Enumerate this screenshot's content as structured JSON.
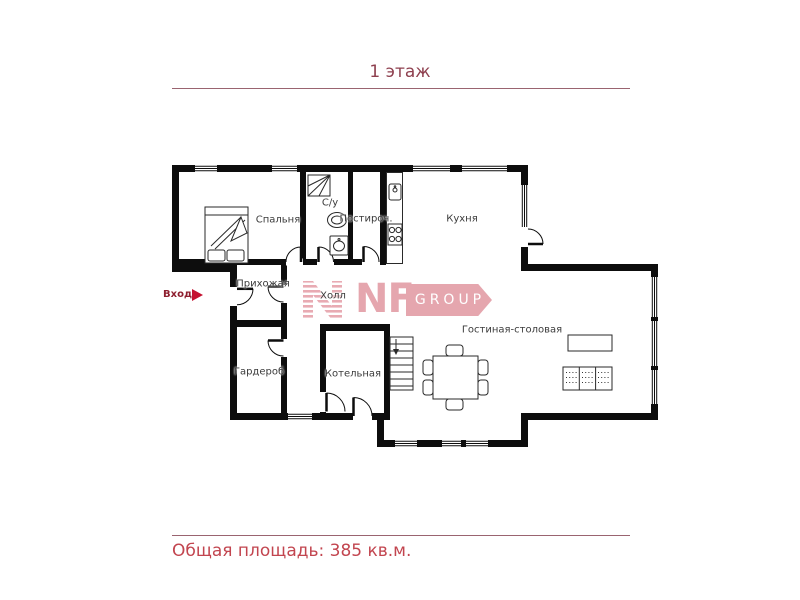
{
  "page": {
    "floor_title": "1 этаж",
    "total_area": "Общая площадь: 385 кв.м."
  },
  "plan": {
    "entrance_label": "Вход",
    "rooms": [
      {
        "name": "bedroom",
        "label": "Спальня"
      },
      {
        "name": "bathroom",
        "label": "С/у"
      },
      {
        "name": "laundry",
        "label": "Постироч."
      },
      {
        "name": "kitchen",
        "label": "Кухня"
      },
      {
        "name": "entry-hall",
        "label": "Прихожая"
      },
      {
        "name": "hall",
        "label": "Холл"
      },
      {
        "name": "living-dining",
        "label": "Гостиная-столовая"
      },
      {
        "name": "wardrobe",
        "label": "Гардероб"
      },
      {
        "name": "boiler-room",
        "label": "Котельная"
      }
    ]
  },
  "logo": {
    "nf": "NF",
    "group": "GROUP"
  },
  "colors": {
    "title": "#8e3f4e",
    "area_text": "#c2454f",
    "rule_line": "#9a6470",
    "entrance_text": "#8e1f2f",
    "entrance_arrow": "#c51230",
    "logo_pink": "#e5a6ae",
    "walls": "#0d0d0d"
  }
}
